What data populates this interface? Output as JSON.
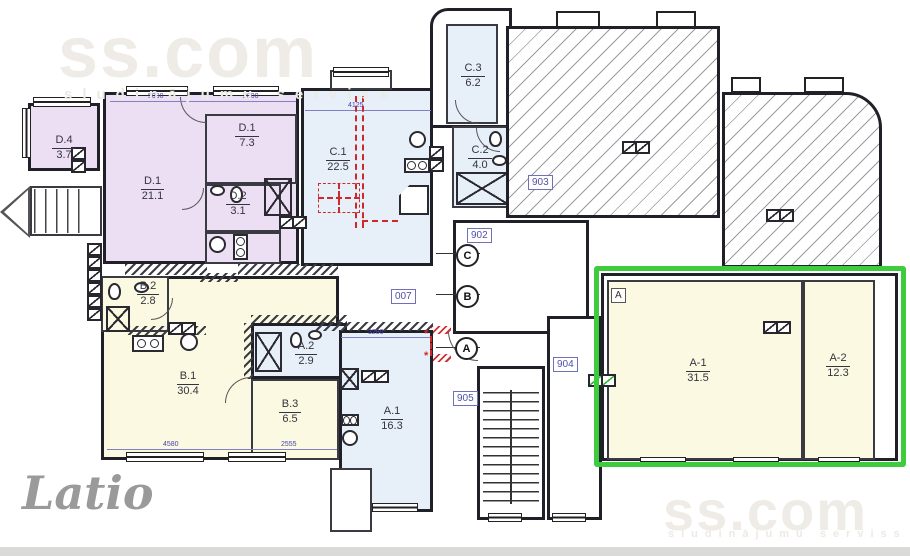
{
  "watermark": {
    "brand": "ss.com",
    "tagline": "sludinājumu serviss",
    "agency_logo": "Latio"
  },
  "rooms": [
    {
      "name": "D.4",
      "area": "3.7"
    },
    {
      "name": "D.1",
      "area": "21.1"
    },
    {
      "name": "D.1",
      "area": "7.3"
    },
    {
      "name": "D.2",
      "area": "3.1"
    },
    {
      "name": "C.1",
      "area": "22.5"
    },
    {
      "name": "C.3",
      "area": "6.2"
    },
    {
      "name": "C.2",
      "area": "4.0"
    },
    {
      "name": "B.2",
      "area": "2.8"
    },
    {
      "name": "B.1",
      "area": "30.4"
    },
    {
      "name": "A.2",
      "area": "2.9"
    },
    {
      "name": "B.3",
      "area": "6.5"
    },
    {
      "name": "A.1",
      "area": "16.3"
    },
    {
      "name": "A-1",
      "area": "31.5"
    },
    {
      "name": "A-2",
      "area": "12.3"
    }
  ],
  "unit_labels": {
    "u007": "007",
    "u902": "902",
    "u903": "903",
    "u904": "904",
    "u905": "905",
    "block_a": "A"
  },
  "grid_markers": {
    "c": "C",
    "b": "B",
    "a": "A"
  },
  "dimensions": {
    "d1": "5090",
    "d2": "2800",
    "d3": "4125",
    "d4": "3280",
    "d5": "4580",
    "d6": "2555"
  },
  "colors": {
    "highlight_green": "#3ecc3e",
    "room_purple": "#ecdff4",
    "room_blue": "#e7eff9",
    "room_cream": "#fcf9e3",
    "label_blue": "#5050a8",
    "red_mark": "#cc2a2a"
  }
}
